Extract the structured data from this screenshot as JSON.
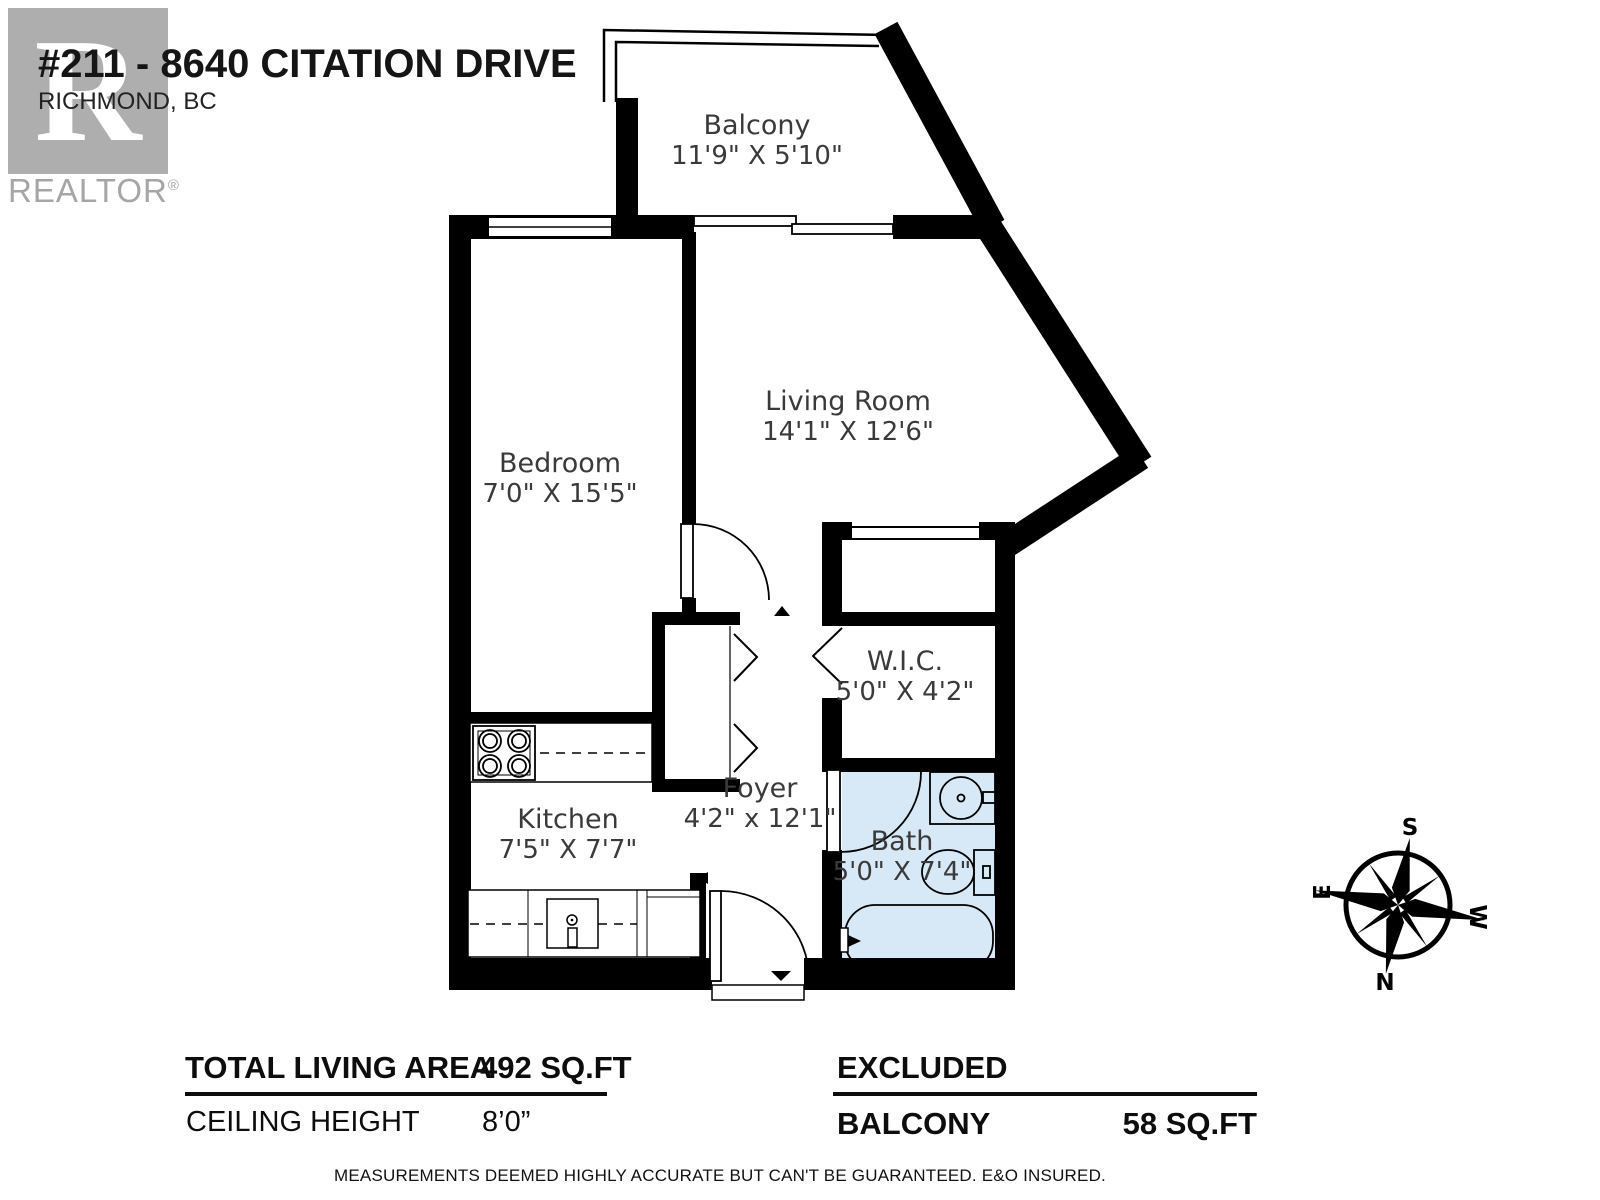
{
  "header": {
    "title": "#211 - 8640 CITATION DRIVE",
    "subtitle": "RICHMOND, BC",
    "logo": {
      "letter": "R",
      "brand": "REALTOR",
      "registered": "®"
    }
  },
  "rooms": {
    "balcony": {
      "name": "Balcony",
      "dims": "11'9\" X 5'10\""
    },
    "living": {
      "name": "Living Room",
      "dims": "14'1\" X 12'6\""
    },
    "bedroom": {
      "name": "Bedroom",
      "dims": "7'0\" X 15'5\""
    },
    "wic": {
      "name": "W.I.C.",
      "dims": "5'0\" X 4'2\""
    },
    "kitchen": {
      "name": "Kitchen",
      "dims": "7'5\" X 7'7\""
    },
    "foyer": {
      "name": "Foyer",
      "dims": "4'2\" x 12'1\""
    },
    "bath": {
      "name": "Bath",
      "dims": "5'0\" X 7'4\""
    }
  },
  "compass": {
    "top": "S",
    "right": "W",
    "bottom": "N",
    "left": "E"
  },
  "summary": {
    "living_area_label": "TOTAL LIVING AREA",
    "living_area_value": "492 SQ.FT",
    "ceiling_label": "CEILING HEIGHT",
    "ceiling_value": "8’0”",
    "excluded_label": "EXCLUDED",
    "excluded_item": "BALCONY",
    "excluded_value": "58 SQ.FT"
  },
  "footer": "MEASUREMENTS DEEMED HIGHLY ACCURATE BUT CAN'T BE GUARANTEED. E&O INSURED.",
  "colors": {
    "wall": "#000000",
    "bath_fill": "#d7e9f6",
    "logo_gray": "#aeaeae",
    "label_text": "#3a3a3a"
  }
}
